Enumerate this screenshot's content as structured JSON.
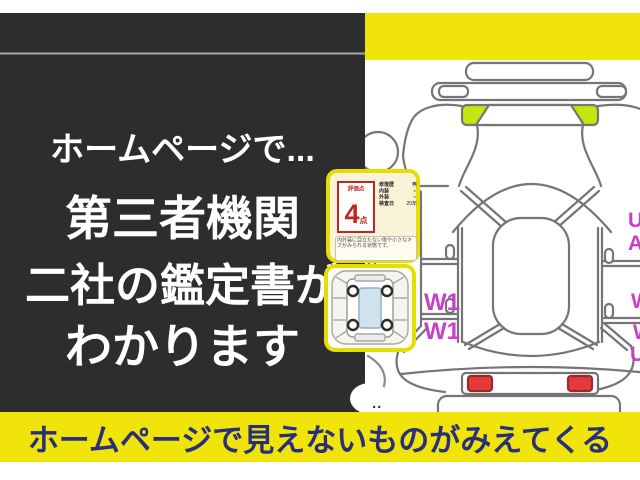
{
  "panel": {
    "line1": "ホームページで...",
    "line2": "第三者機関",
    "line3": "二社の鑑定書が",
    "line4": "わかります"
  },
  "banner": {
    "text": "ホームページで見えないものがみえてくる"
  },
  "certificate": {
    "score_label": "評価点",
    "score_value": "4",
    "score_unit": "点",
    "fields": [
      {
        "label": "修復歴",
        "value": "無"
      },
      {
        "label": "内装",
        "value": "★"
      },
      {
        "label": "外装",
        "value": "★"
      },
      {
        "label": "検査日",
        "value": "20年"
      }
    ],
    "note": "内外装に目立たない傷や小さなキズがみられる状態です。"
  },
  "diagram": {
    "left_labels": [
      "W1",
      "W1"
    ],
    "right_labels": [
      "U",
      "A",
      "W",
      "W",
      "U"
    ],
    "dots": ".."
  },
  "colors": {
    "yellow": "#f1e40b",
    "dark_panel": "#2d2d2d",
    "banner_text_navy": "#28307c",
    "highlight_green": "#c5e50e",
    "taillight_red": "#e63a3a",
    "code_magenta": "#c93fc9",
    "cert_red": "#c22424"
  }
}
